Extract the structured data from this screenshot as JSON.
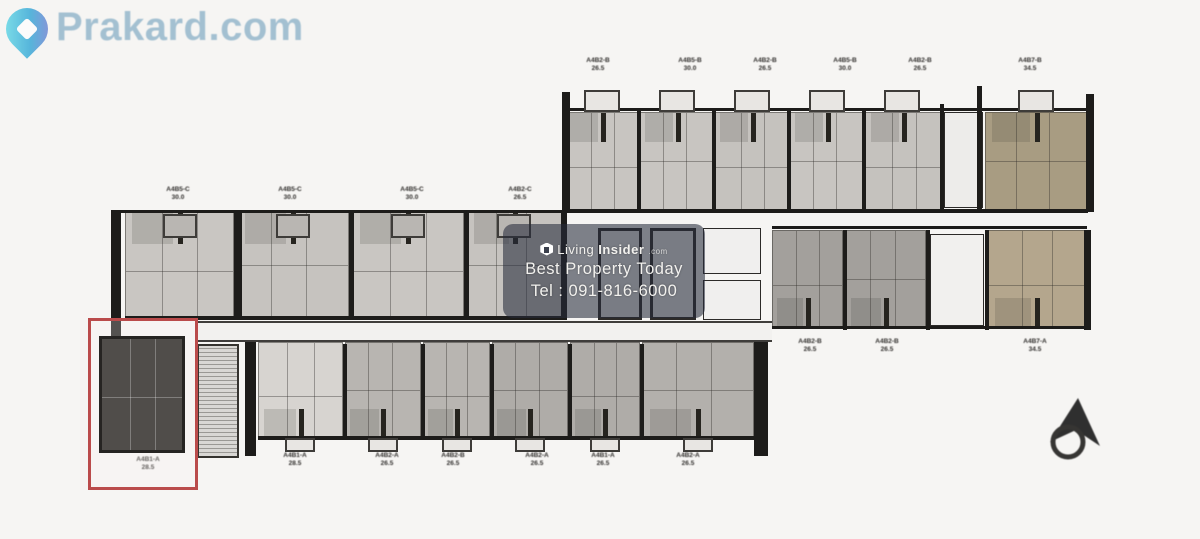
{
  "logo": {
    "text": "Prakard.com",
    "color": "#8fb3c9",
    "pin_color": "#3ab5dc"
  },
  "watermark": {
    "brand_light": "Living",
    "brand_bold": "Insider",
    "brand_tld": ".com",
    "tagline": "Best Property Today",
    "phone": "Tel : 091-816-6000"
  },
  "colors": {
    "highlight_red": "#ba4b4b",
    "unit_gray": "#c8c5c1",
    "unit_dark_gray": "#a3a09c",
    "unit_khaki": "#a89c82",
    "unit_beige": "#b4a68d",
    "selected_unit_fill": "#504d4a"
  },
  "floorplan": {
    "corridor": {
      "x": 196,
      "y": 321,
      "w": 576,
      "h": 21
    },
    "stairs": {
      "x": 197,
      "y": 344,
      "w": 42,
      "h": 114
    },
    "units": [
      {
        "x": 565,
        "y": 112,
        "w": 75,
        "h": 98,
        "fill": "#c8c5c1",
        "stub": "top"
      },
      {
        "x": 640,
        "y": 112,
        "w": 75,
        "h": 98,
        "fill": "#c8c5c1",
        "stub": "top"
      },
      {
        "x": 715,
        "y": 112,
        "w": 75,
        "h": 98,
        "fill": "#c5c2be",
        "stub": "top"
      },
      {
        "x": 790,
        "y": 112,
        "w": 75,
        "h": 98,
        "fill": "#c8c5c1",
        "stub": "top"
      },
      {
        "x": 865,
        "y": 112,
        "w": 77,
        "h": 98,
        "fill": "#c5c2be",
        "stub": "top"
      },
      {
        "x": 985,
        "y": 112,
        "w": 103,
        "h": 98,
        "fill": "#a89c82",
        "stub": "top"
      },
      {
        "x": 125,
        "y": 212,
        "w": 109,
        "h": 106,
        "fill": "#c9c6c2",
        "stub": "top"
      },
      {
        "x": 237,
        "y": 212,
        "w": 112,
        "h": 106,
        "fill": "#c6c3bf",
        "stub": "top"
      },
      {
        "x": 352,
        "y": 212,
        "w": 112,
        "h": 106,
        "fill": "#c9c6c2",
        "stub": "top"
      },
      {
        "x": 467,
        "y": 212,
        "w": 95,
        "h": 106,
        "fill": "#c6c3bf",
        "stub": "top"
      },
      {
        "x": 258,
        "y": 342,
        "w": 85,
        "h": 96,
        "fill": "#d7d4d0",
        "stub": "bottom"
      },
      {
        "x": 345,
        "y": 342,
        "w": 76,
        "h": 96,
        "fill": "#b8b5b1",
        "stub": "bottom"
      },
      {
        "x": 423,
        "y": 342,
        "w": 67,
        "h": 96,
        "fill": "#b8b5b1",
        "stub": "bottom"
      },
      {
        "x": 492,
        "y": 342,
        "w": 76,
        "h": 96,
        "fill": "#afaca8",
        "stub": "bottom"
      },
      {
        "x": 570,
        "y": 342,
        "w": 70,
        "h": 96,
        "fill": "#afaca8",
        "stub": "bottom"
      },
      {
        "x": 642,
        "y": 342,
        "w": 112,
        "h": 96,
        "fill": "#b3b0ac",
        "stub": "bottom"
      },
      {
        "x": 772,
        "y": 230,
        "w": 71,
        "h": 98,
        "fill": "#a3a09c",
        "stub": "bottom"
      },
      {
        "x": 845,
        "y": 230,
        "w": 81,
        "h": 98,
        "fill": "#a3a09c",
        "stub": "bottom"
      },
      {
        "x": 988,
        "y": 230,
        "w": 98,
        "h": 98,
        "fill": "#b4a68d",
        "stub": "bottom"
      }
    ],
    "cores": [
      {
        "x": 598,
        "y": 228,
        "w": 44,
        "h": 92,
        "bw": 3,
        "fill": "#ebebea"
      },
      {
        "x": 650,
        "y": 228,
        "w": 46,
        "h": 92,
        "bw": 3,
        "fill": "#ebebea"
      },
      {
        "x": 703,
        "y": 228,
        "w": 58,
        "h": 46,
        "bw": 1,
        "fill": "#f0efee"
      },
      {
        "x": 703,
        "y": 280,
        "w": 58,
        "h": 40,
        "bw": 1,
        "fill": "#f0efee"
      },
      {
        "x": 930,
        "y": 234,
        "w": 54,
        "h": 92,
        "bw": 1,
        "fill": "#f1f0ee"
      },
      {
        "x": 944,
        "y": 112,
        "w": 39,
        "h": 96,
        "bw": 1,
        "fill": "#edecea"
      }
    ],
    "walls": [
      {
        "x": 562,
        "y": 92,
        "w": 8,
        "h": 120
      },
      {
        "x": 637,
        "y": 108,
        "w": 4,
        "h": 104
      },
      {
        "x": 712,
        "y": 108,
        "w": 4,
        "h": 104
      },
      {
        "x": 787,
        "y": 108,
        "w": 4,
        "h": 104
      },
      {
        "x": 862,
        "y": 108,
        "w": 4,
        "h": 104
      },
      {
        "x": 940,
        "y": 104,
        "w": 4,
        "h": 108
      },
      {
        "x": 977,
        "y": 86,
        "w": 5,
        "h": 126
      },
      {
        "x": 1086,
        "y": 94,
        "w": 8,
        "h": 118
      },
      {
        "x": 565,
        "y": 108,
        "w": 521,
        "h": 3
      },
      {
        "x": 565,
        "y": 209,
        "w": 523,
        "h": 4
      },
      {
        "x": 111,
        "y": 210,
        "w": 10,
        "h": 136
      },
      {
        "x": 234,
        "y": 212,
        "w": 8,
        "h": 108
      },
      {
        "x": 349,
        "y": 212,
        "w": 5,
        "h": 108
      },
      {
        "x": 464,
        "y": 212,
        "w": 5,
        "h": 108
      },
      {
        "x": 561,
        "y": 212,
        "w": 6,
        "h": 108
      },
      {
        "x": 121,
        "y": 210,
        "w": 441,
        "h": 3
      },
      {
        "x": 125,
        "y": 316,
        "w": 437,
        "h": 4
      },
      {
        "x": 245,
        "y": 338,
        "w": 11,
        "h": 118
      },
      {
        "x": 754,
        "y": 328,
        "w": 14,
        "h": 128
      },
      {
        "x": 343,
        "y": 344,
        "w": 4,
        "h": 96
      },
      {
        "x": 421,
        "y": 344,
        "w": 4,
        "h": 96
      },
      {
        "x": 490,
        "y": 344,
        "w": 4,
        "h": 96
      },
      {
        "x": 568,
        "y": 344,
        "w": 4,
        "h": 96
      },
      {
        "x": 640,
        "y": 344,
        "w": 4,
        "h": 96
      },
      {
        "x": 256,
        "y": 338,
        "w": 499,
        "h": 4
      },
      {
        "x": 258,
        "y": 436,
        "w": 497,
        "h": 4
      },
      {
        "x": 772,
        "y": 226,
        "w": 315,
        "h": 3
      },
      {
        "x": 843,
        "y": 230,
        "w": 4,
        "h": 100
      },
      {
        "x": 926,
        "y": 230,
        "w": 4,
        "h": 100
      },
      {
        "x": 985,
        "y": 230,
        "w": 4,
        "h": 100
      },
      {
        "x": 1084,
        "y": 230,
        "w": 7,
        "h": 100
      },
      {
        "x": 772,
        "y": 326,
        "w": 315,
        "h": 3
      }
    ],
    "tabs_outer": [
      {
        "x": 584,
        "y": 90,
        "w": 36,
        "h": 22
      },
      {
        "x": 659,
        "y": 90,
        "w": 36,
        "h": 22
      },
      {
        "x": 734,
        "y": 90,
        "w": 36,
        "h": 22
      },
      {
        "x": 809,
        "y": 90,
        "w": 36,
        "h": 22
      },
      {
        "x": 884,
        "y": 90,
        "w": 36,
        "h": 22
      },
      {
        "x": 1018,
        "y": 90,
        "w": 36,
        "h": 22
      },
      {
        "x": 285,
        "y": 438,
        "w": 30,
        "h": 14
      },
      {
        "x": 368,
        "y": 438,
        "w": 30,
        "h": 14
      },
      {
        "x": 442,
        "y": 438,
        "w": 30,
        "h": 14
      },
      {
        "x": 515,
        "y": 438,
        "w": 30,
        "h": 14
      },
      {
        "x": 590,
        "y": 438,
        "w": 30,
        "h": 14
      },
      {
        "x": 683,
        "y": 438,
        "w": 30,
        "h": 14
      }
    ],
    "tabs_inner": [
      {
        "x": 163,
        "y": 214,
        "w": 34,
        "h": 24
      },
      {
        "x": 276,
        "y": 214,
        "w": 34,
        "h": 24
      },
      {
        "x": 391,
        "y": 214,
        "w": 34,
        "h": 24
      },
      {
        "x": 497,
        "y": 214,
        "w": 34,
        "h": 24
      }
    ],
    "labels": [
      {
        "x": 598,
        "y": 57,
        "code": "A4B2-B",
        "area": "26.5"
      },
      {
        "x": 690,
        "y": 57,
        "code": "A4B5-B",
        "area": "30.0"
      },
      {
        "x": 765,
        "y": 57,
        "code": "A4B2-B",
        "area": "26.5"
      },
      {
        "x": 845,
        "y": 57,
        "code": "A4B5-B",
        "area": "30.0"
      },
      {
        "x": 920,
        "y": 57,
        "code": "A4B2-B",
        "area": "26.5"
      },
      {
        "x": 1030,
        "y": 57,
        "code": "A4B7-B",
        "area": "34.5"
      },
      {
        "x": 178,
        "y": 186,
        "code": "A4B5-C",
        "area": "30.0"
      },
      {
        "x": 290,
        "y": 186,
        "code": "A4B5-C",
        "area": "30.0"
      },
      {
        "x": 412,
        "y": 186,
        "code": "A4B5-C",
        "area": "30.0"
      },
      {
        "x": 520,
        "y": 186,
        "code": "A4B2-C",
        "area": "26.5"
      },
      {
        "x": 295,
        "y": 452,
        "code": "A4B1-A",
        "area": "28.5"
      },
      {
        "x": 387,
        "y": 452,
        "code": "A4B2-A",
        "area": "26.5"
      },
      {
        "x": 453,
        "y": 452,
        "code": "A4B2-B",
        "area": "26.5"
      },
      {
        "x": 537,
        "y": 452,
        "code": "A4B2-A",
        "area": "26.5"
      },
      {
        "x": 603,
        "y": 452,
        "code": "A4B1-A",
        "area": "26.5"
      },
      {
        "x": 688,
        "y": 452,
        "code": "A4B2-A",
        "area": "26.5"
      },
      {
        "x": 810,
        "y": 338,
        "code": "A4B2-B",
        "area": "26.5"
      },
      {
        "x": 887,
        "y": 338,
        "code": "A4B2-B",
        "area": "26.5"
      },
      {
        "x": 1035,
        "y": 338,
        "code": "A4B7-A",
        "area": "34.5"
      },
      {
        "x": 148,
        "y": 456,
        "code": "A4B1-A",
        "area": "28.5"
      }
    ],
    "highlight": {
      "box": {
        "x": 88,
        "y": 318,
        "w": 110,
        "h": 172
      },
      "unit": {
        "x": 99,
        "y": 336,
        "w": 86,
        "h": 117
      }
    }
  }
}
